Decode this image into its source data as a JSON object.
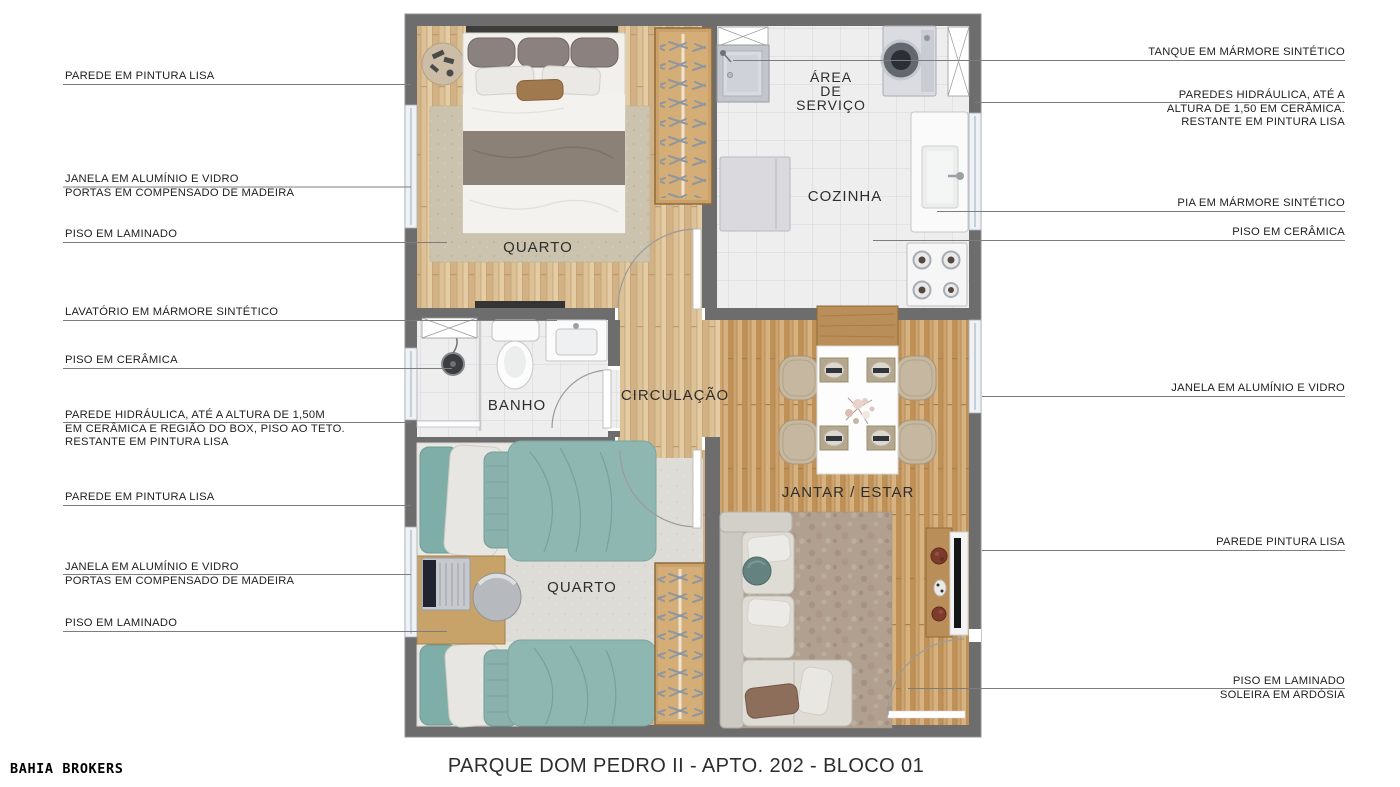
{
  "title": "PARQUE DOM PEDRO II - APTO. 202 - BLOCO 01",
  "brand": "BAHIA BROKERS",
  "room_labels": {
    "quarto1": "QUARTO",
    "area_servico": [
      "ÁREA",
      "DE",
      "SERVIÇO"
    ],
    "cozinha": "COZINHA",
    "banho": "BANHO",
    "circulacao": "CIRCULAÇÃO",
    "jantar_estar": "JANTAR / ESTAR",
    "quarto2": "QUARTO"
  },
  "annotations_left": [
    {
      "lines": [
        "PAREDE EM PINTURA LISA"
      ]
    },
    {
      "lines": [
        "JANELA EM ALUMÍNIO E VIDRO",
        "PORTAS EM COMPENSADO DE MADEIRA"
      ]
    },
    {
      "lines": [
        "PISO EM LAMINADO"
      ]
    },
    {
      "lines": [
        "LAVATÓRIO EM MÁRMORE SINTÉTICO"
      ]
    },
    {
      "lines": [
        "PISO EM CERÂMICA"
      ]
    },
    {
      "lines": [
        "PAREDE HIDRÁULICA, ATÉ A ALTURA DE 1,50M",
        "EM CERÂMICA E REGIÃO DO BOX, PISO AO TETO.",
        "RESTANTE EM PINTURA LISA"
      ]
    },
    {
      "lines": [
        "PAREDE EM PINTURA LISA"
      ]
    },
    {
      "lines": [
        "JANELA EM ALUMÍNIO E VIDRO",
        "PORTAS EM COMPENSADO DE MADEIRA"
      ]
    },
    {
      "lines": [
        "PISO EM LAMINADO"
      ]
    }
  ],
  "annotations_right": [
    {
      "lines": [
        "TANQUE EM MÁRMORE SINTÉTICO"
      ]
    },
    {
      "lines": [
        "PAREDES HIDRÁULICA, ATÉ A",
        "ALTURA DE 1,50 EM CERÂMICA.",
        "RESTANTE EM PINTURA LISA"
      ]
    },
    {
      "lines": [
        "PIA EM MÁRMORE SINTÉTICO"
      ]
    },
    {
      "lines": [
        "PISO EM CERÂMICA"
      ]
    },
    {
      "lines": [
        "JANELA EM ALUMÍNIO E VIDRO"
      ]
    },
    {
      "lines": [
        "PAREDE PINTURA LISA"
      ]
    },
    {
      "lines": [
        "PISO EM LAMINADO",
        "SOLEIRA EM ARDÓSIA"
      ]
    }
  ],
  "colors": {
    "wall": "#6e6d6e",
    "wood_light": "#dcc096",
    "wood_living": "#cda470",
    "tile": "#eeeeef",
    "teal_bedding": "#8fb7b1",
    "leader_line": "#7d7d7d"
  }
}
